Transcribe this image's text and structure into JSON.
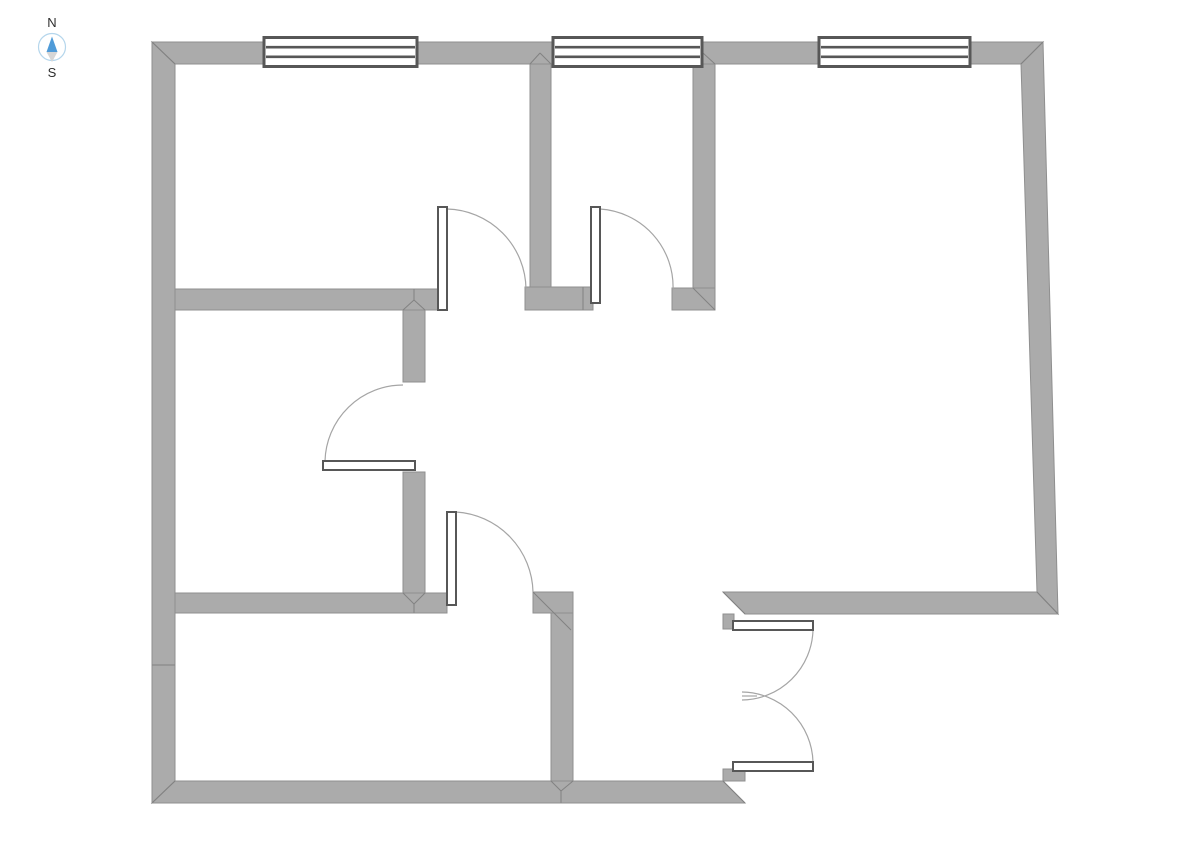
{
  "meta": {
    "canvas_width": 1191,
    "canvas_height": 842
  },
  "colors": {
    "background": "#ffffff",
    "wall_fill": "#ababab",
    "wall_edge": "#8f8f8f",
    "seam": "#828282",
    "frame_dark": "#575757",
    "fixture_fill": "#ffffff",
    "swing_arc": "#a5a5a5",
    "compass_needle_north": "#4f9bd8",
    "compass_needle_south": "#d6d6d6",
    "compass_ring": "#b5d6ec",
    "compass_text": "#2e2e2e"
  },
  "compass": {
    "north_label": "N",
    "south_label": "S",
    "cx": 52,
    "cy": 47,
    "r": 13.5,
    "needle_north_points": "52,36.5 46.5,52 57.5,52",
    "needle_south_points": "46.5,52 57.5,52 52,62",
    "north_label_x": 52,
    "north_label_y": 27,
    "south_label_x": 52,
    "south_label_y": 77
  },
  "floorplan": {
    "walls": [
      {
        "name": "outer-wall-top",
        "points": "152,42 1043,42 1021,64 175,64"
      },
      {
        "name": "outer-wall-left",
        "points": "152,42 175,64 175,781 152,803"
      },
      {
        "name": "outer-wall-bottom",
        "points": "152,803 175,781 723,781 745,803"
      },
      {
        "name": "outer-wall-right",
        "points": "1043,42 1058,614 1037,592 1021,64"
      },
      {
        "name": "right-room-bottom-wall",
        "points": "723,592 1037,592 1058,614 745,614"
      },
      {
        "name": "interior-wall-h-upper",
        "points": "175,289 442,289 442,310 175,310"
      },
      {
        "name": "interior-wall-v-top",
        "points": "530,64 551,64 551,287 530,287"
      },
      {
        "name": "interior-wall-stub-mid",
        "points": "525,287 593,287 593,310 525,310"
      },
      {
        "name": "interior-wall-v-window-right",
        "points": "693,64 715,64 715,288 693,288"
      },
      {
        "name": "interior-wall-end-cap",
        "points": "672,288 715,288 715,310 672,310"
      },
      {
        "name": "interior-wall-v-mid-upper",
        "points": "403,310 425,310 425,382 403,382"
      },
      {
        "name": "interior-wall-v-mid-lower",
        "points": "403,472 425,472 425,593 403,593"
      },
      {
        "name": "interior-wall-h-lower",
        "points": "175,593 447,593 447,613 175,613"
      },
      {
        "name": "interior-wall-corner-stub",
        "points": "533,592 573,592 573,613 533,613"
      },
      {
        "name": "interior-wall-v-bottom",
        "points": "551,613 573,613 573,781 551,781"
      },
      {
        "name": "door-jamb-top",
        "points": "723,614 734,614 734,629 723,629"
      },
      {
        "name": "door-jamb-bottom",
        "points": "723,769 745,769 745,781 723,781"
      }
    ],
    "seams": [
      {
        "name": "miter-top-left",
        "x1": 152,
        "y1": 42,
        "x2": 175,
        "y2": 64
      },
      {
        "name": "miter-top-right",
        "x1": 1043,
        "y1": 42,
        "x2": 1021,
        "y2": 64
      },
      {
        "name": "miter-bottom-left",
        "x1": 152,
        "y1": 803,
        "x2": 175,
        "y2": 781
      },
      {
        "name": "miter-bottom-right",
        "x1": 1037,
        "y1": 592,
        "x2": 1058,
        "y2": 614
      },
      {
        "name": "miter-bottom-wall-end",
        "x1": 723,
        "y1": 781,
        "x2": 745,
        "y2": 803
      },
      {
        "name": "miter-right-room-end",
        "x1": 723,
        "y1": 592,
        "x2": 745,
        "y2": 614
      },
      {
        "name": "miter-end-cap",
        "x1": 693,
        "y1": 288,
        "x2": 715,
        "y2": 310
      },
      {
        "name": "seam-stub-mid",
        "x1": 583,
        "y1": 287,
        "x2": 583,
        "y2": 310
      },
      {
        "name": "miter-t-top-a",
        "x1": 530,
        "y1": 64,
        "x2": 540,
        "y2": 53
      },
      {
        "name": "miter-t-top-b",
        "x1": 551,
        "y1": 64,
        "x2": 540,
        "y2": 53
      },
      {
        "name": "miter-t-top-c",
        "x1": 693,
        "y1": 64,
        "x2": 703,
        "y2": 53
      },
      {
        "name": "miter-t-top-d",
        "x1": 715,
        "y1": 64,
        "x2": 703,
        "y2": 53
      },
      {
        "name": "miter-t-mid-a",
        "x1": 403,
        "y1": 310,
        "x2": 414,
        "y2": 300
      },
      {
        "name": "miter-t-mid-b",
        "x1": 425,
        "y1": 310,
        "x2": 414,
        "y2": 300
      },
      {
        "name": "miter-t-mid-c",
        "x1": 414,
        "y1": 289,
        "x2": 414,
        "y2": 300
      },
      {
        "name": "miter-t-low-a",
        "x1": 403,
        "y1": 593,
        "x2": 414,
        "y2": 604
      },
      {
        "name": "miter-t-low-b",
        "x1": 425,
        "y1": 593,
        "x2": 414,
        "y2": 604
      },
      {
        "name": "miter-t-low-c",
        "x1": 414,
        "y1": 604,
        "x2": 414,
        "y2": 613
      },
      {
        "name": "miter-t-bottom-a",
        "x1": 551,
        "y1": 781,
        "x2": 561,
        "y2": 791
      },
      {
        "name": "miter-t-bottom-b",
        "x1": 573,
        "y1": 781,
        "x2": 561,
        "y2": 791
      },
      {
        "name": "miter-t-bottom-c",
        "x1": 561,
        "y1": 791,
        "x2": 561,
        "y2": 803
      },
      {
        "name": "miter-corner-stub",
        "x1": 533,
        "y1": 592,
        "x2": 571,
        "y2": 630
      },
      {
        "name": "seam-left-wall",
        "x1": 152,
        "y1": 665,
        "x2": 175,
        "y2": 665
      }
    ],
    "windows": [
      {
        "name": "window-1",
        "x1": 264,
        "x2": 417,
        "y": 37.5,
        "h": 29
      },
      {
        "name": "window-2",
        "x1": 553,
        "x2": 702,
        "y": 37.5,
        "h": 29
      },
      {
        "name": "window-3",
        "x1": 819,
        "x2": 970,
        "y": 37.5,
        "h": 29
      }
    ],
    "doors": [
      {
        "name": "door-1",
        "leaf": {
          "x": 438,
          "y": 207,
          "w": 9,
          "h": 103
        },
        "swing": "M447,209 A81,81 0 0 1 526,289"
      },
      {
        "name": "door-2",
        "leaf": {
          "x": 591,
          "y": 207,
          "w": 9,
          "h": 96
        },
        "swing": "M600,209 A78,78 0 0 1 673,290"
      },
      {
        "name": "door-3",
        "leaf": {
          "x": 323,
          "y": 461,
          "w": 92,
          "h": 9
        },
        "swing": "M325,461 A78,78 0 0 1 403,385"
      },
      {
        "name": "door-4",
        "leaf": {
          "x": 447,
          "y": 512,
          "w": 9,
          "h": 93
        },
        "swing": "M456,512 A82,82 0 0 1 533,592"
      },
      {
        "name": "door-5",
        "leaf": {
          "x": 733,
          "y": 621,
          "w": 80,
          "h": 9
        },
        "swing": "M813,630 A72,72 0 0 1 742,700"
      },
      {
        "name": "door-6",
        "leaf": {
          "x": 733,
          "y": 762,
          "w": 80,
          "h": 9
        },
        "swing": "M813,762 A72,72 0 0 0 742,692"
      }
    ],
    "extras": [
      {
        "name": "double-door-meeting-tick",
        "path": "M742,696 L757,696"
      }
    ]
  }
}
